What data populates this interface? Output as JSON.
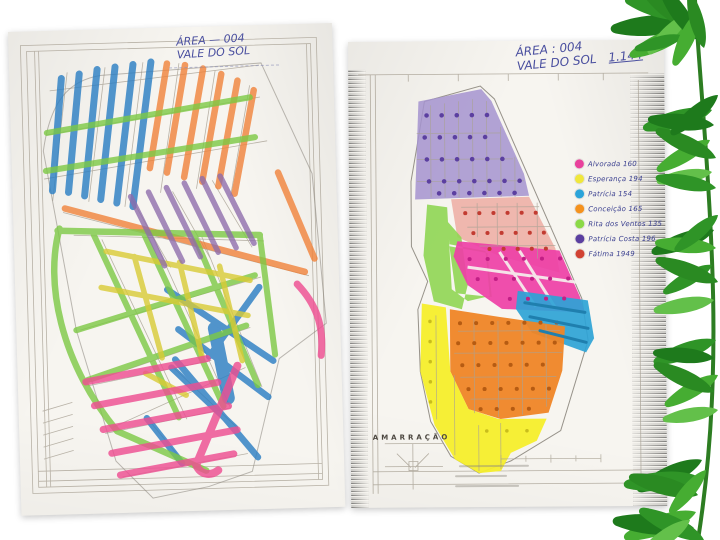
{
  "page": {
    "background": "#ffffff",
    "description": "Two scanned hand-coloured street maps of the same neighbourhood, with green plant foliage along the right edge"
  },
  "left_map": {
    "title_line1": "ÁREA — 004",
    "title_line2": "VALE DO SOL",
    "highlight_colors": {
      "blue": "#2d7fc4",
      "orange": "#f0823a",
      "green": "#7cc944",
      "yellow": "#d9cb35",
      "purple": "#8d6cab",
      "pink": "#ee4f92",
      "magenta": "#e8428f"
    }
  },
  "right_map": {
    "title_line1": "ÁREA : 004",
    "title_line2": "VALE DO SOL",
    "total": "1.144",
    "inset_label": "AMARRAÇÃO",
    "zone_colors": {
      "purple": "#a493cf",
      "salmon": "#edb0a6",
      "green": "#8fd653",
      "magenta": "#ee3fa6",
      "blue": "#2ea3d6",
      "orange": "#ef8526",
      "yellow": "#f6ee2b"
    },
    "legend": {
      "items": [
        {
          "label": "Alvorada 160",
          "color": "#e9419c"
        },
        {
          "label": "Esperança 194",
          "color": "#f0e73b"
        },
        {
          "label": "Patrícia 154",
          "color": "#2ba4da"
        },
        {
          "label": "Conceição 165",
          "color": "#f5921e"
        },
        {
          "label": "Rita dos Ventos 135",
          "color": "#8bd947"
        },
        {
          "label": "Patrícia Costa 196",
          "color": "#5b3fa0"
        },
        {
          "label": "Fátima 1949",
          "color": "#d14233"
        }
      ]
    }
  }
}
